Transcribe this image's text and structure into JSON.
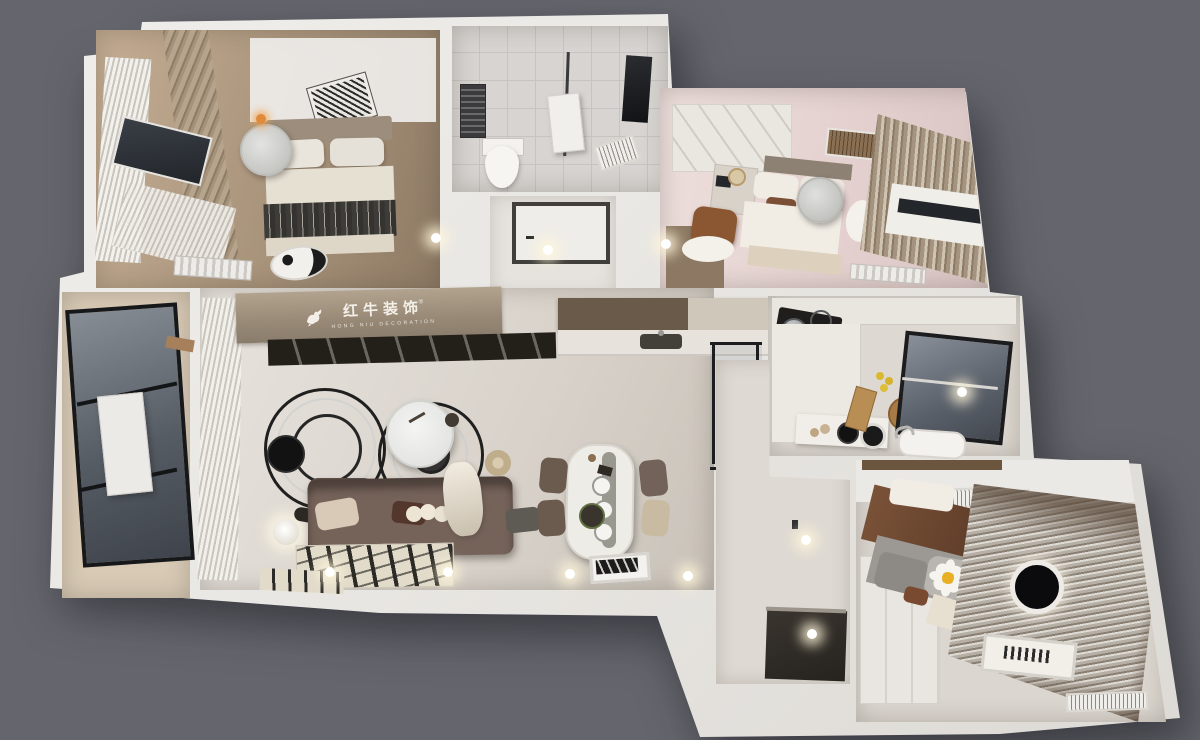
{
  "scene": {
    "description": "3D top-down dollhouse rendering of a three-bedroom apartment interior design",
    "background_color": "#65656d"
  },
  "brand": {
    "name": "红牛装饰",
    "tagline": "HONG NIU DECORATION",
    "registered": "®",
    "logo_color": "#f3efe8",
    "wall_band_color": "#9a8b78"
  },
  "palette": {
    "wall_white": "#ebe9e5",
    "wall_shadow": "#d7d4cf",
    "wood_floor": "#ab947c",
    "living_floor": "#ddd8d1",
    "bathroom_tile": "#d7d4d1",
    "pink_room_floor": "#e6d4d2",
    "balcony_glass": "#5a6068",
    "sofa_brown": "#716057",
    "bed_blanket_dark": "#3d3c38",
    "entry_floor_dark": "#2d2a26",
    "curtain_taupe": "#948678",
    "ceiling_lamp_gray": "#d6d6d4",
    "bedroom3_lamp_black": "#0b0b0d",
    "downlight_glow": "#fff6da"
  }
}
